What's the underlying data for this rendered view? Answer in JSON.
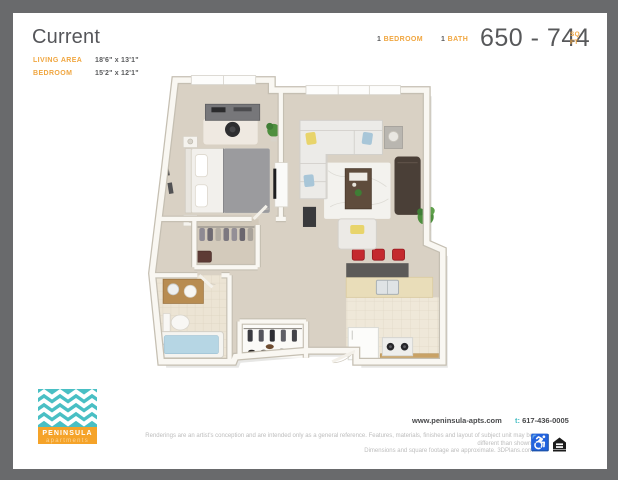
{
  "header": {
    "title": "Current",
    "dimensions": [
      {
        "label": "LIVING AREA",
        "value": "18'6\" x 13'1\""
      },
      {
        "label": "BEDROOM",
        "value": "15'2\" x 12'1\""
      }
    ],
    "bedroom_count": "1",
    "bedroom_label": "BEDROOM",
    "bath_count": "1",
    "bath_label": "BATH",
    "sqft_range": "650 - 744",
    "sqft_unit_top": "SQ",
    "sqft_unit_bottom": "FT"
  },
  "logo": {
    "name": "PENINSULA",
    "subtitle": "apartments"
  },
  "footer": {
    "website": "www.peninsula-apts.com",
    "phone_prefix": "t:",
    "phone": " 617-436-0005",
    "disclaimer_line1": "Renderings are an artist's conception and are intended only as a general reference. Features, materials, finishes and layout of subject unit may be different than shown.",
    "disclaimer_line2": "Dimensions and square footage are approximate. 3DPlans.com"
  },
  "icons": {
    "wheelchair": "wheelchair-accessible-icon",
    "equal_housing": "equal-housing-opportunity-icon",
    "wheelchair_glyph": "♿"
  },
  "colors": {
    "accent_orange": "#F0A640",
    "logo_teal": "#49BFC4",
    "logo_orange": "#F5A329",
    "phone_teal": "#45BDC3",
    "text_dark": "#58595B",
    "frame_gray": "#696A6C",
    "stool_red": "#C4292E"
  }
}
